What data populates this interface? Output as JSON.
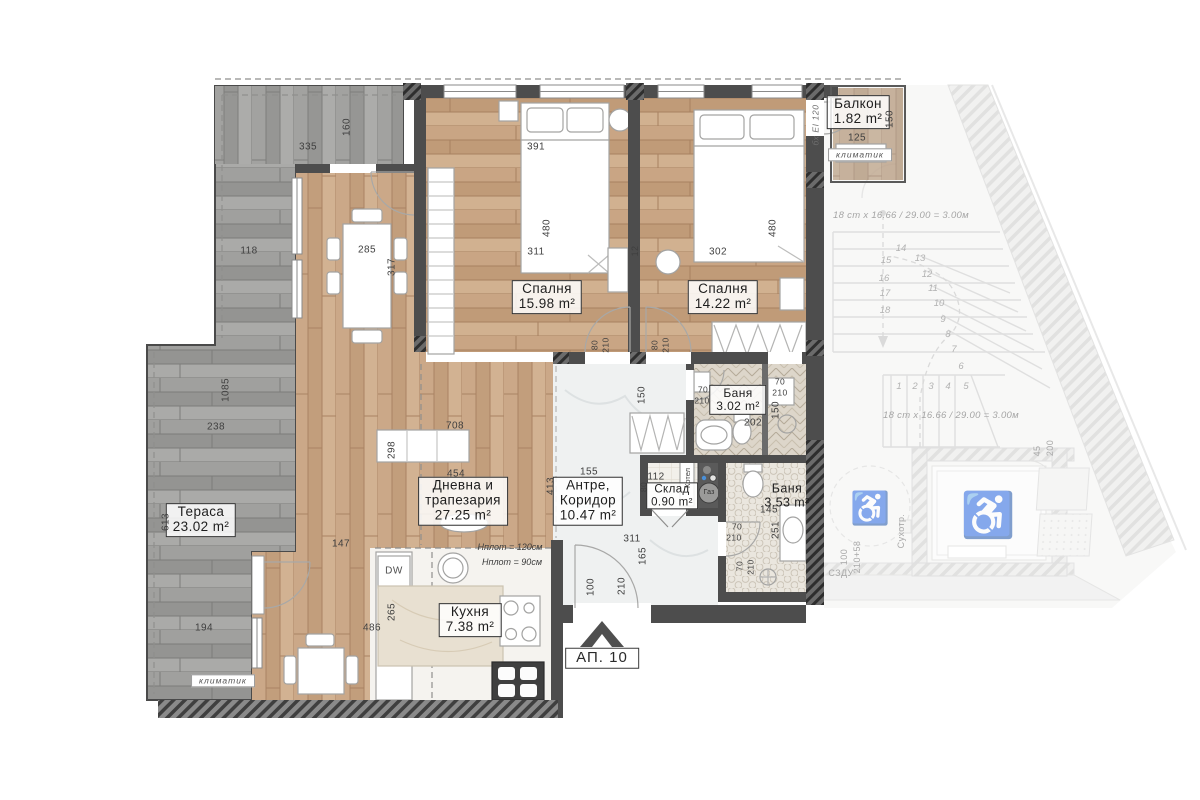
{
  "apartment": {
    "label": "АП. 10"
  },
  "rooms": {
    "balcony": {
      "name": "Балкон",
      "area": "1.82 m²"
    },
    "bedroom1": {
      "name": "Спалня",
      "area": "15.98 m²"
    },
    "bedroom2": {
      "name": "Спалня",
      "area": "14.22 m²"
    },
    "bath1": {
      "name": "Баня",
      "area": "3.02 m²"
    },
    "bath2": {
      "name": "Баня",
      "area": "3.53 m²"
    },
    "storage": {
      "name": "Склад",
      "area": "0.90 m²"
    },
    "hallway": {
      "line1": "Антре,",
      "line2": "Коридор",
      "area": "10.47 m²"
    },
    "living": {
      "line1": "Дневна и",
      "line2": "трапезария",
      "area": "27.25 m²"
    },
    "kitchen": {
      "name": "Кухня",
      "area": "7.38 m²"
    },
    "terrace": {
      "name": "Тераса",
      "area": "23.02 m²"
    }
  },
  "annotations": {
    "ac_top": "климатик",
    "ac_bottom": "климатик",
    "stairs_note_top": "18 ст х 16.66 / 29.00 = 3.00м",
    "stairs_note_bottom": "18 ст х 16.66 / 29.00 = 3.00м",
    "boiler": "Котел",
    "gas": "Газ",
    "dishwasher": "DW",
    "counter_h1": "Hплот = 120см",
    "counter_h2": "Hплот = 90см",
    "szdu": "СЗДУ",
    "dry_riser": "Сухотр.",
    "fire_note": "бх EI 120"
  },
  "dims": {
    "t335": "335",
    "t160": "160",
    "t391": "391",
    "t12": "12",
    "t125": "125",
    "t150b": "150",
    "b1_480": "480",
    "b1_311": "311",
    "b2_480": "480",
    "b2_302": "302",
    "l118": "118",
    "l285": "285",
    "l317": "317",
    "l1085": "1085",
    "l238": "238",
    "l613": "613",
    "l194": "194",
    "k486": "486",
    "k265": "265",
    "k147": "147",
    "k100": "100",
    "k210": "210",
    "lv298": "298",
    "lv708": "708",
    "lv454": "454",
    "lv413": "413",
    "h155": "155",
    "h311": "311",
    "h165": "165",
    "h150": "150",
    "d80a": "80",
    "d210a": "210",
    "d80b": "80",
    "d210b": "210",
    "ba1_70a": "70",
    "ba1_210a": "210",
    "ba1_70b": "70",
    "ba1_210b": "210",
    "ba1_202": "202",
    "ba1_150": "150",
    "st112": "112",
    "st80": "80",
    "ba2_145": "145",
    "ba2_251": "251",
    "ba2_70a": "70",
    "ba2_210a": "210",
    "ba2_70b": "70",
    "ba2_210b": "210",
    "lob100": "100",
    "lob210": "210+58",
    "el45": "45",
    "el200": "200"
  },
  "stairs": {
    "steps": [
      "1",
      "2",
      "3",
      "4",
      "5",
      "6",
      "7",
      "8",
      "9",
      "10",
      "11",
      "12",
      "13",
      "14",
      "15",
      "16",
      "17",
      "18"
    ]
  },
  "symbols": {
    "wheelchair": "♿"
  }
}
